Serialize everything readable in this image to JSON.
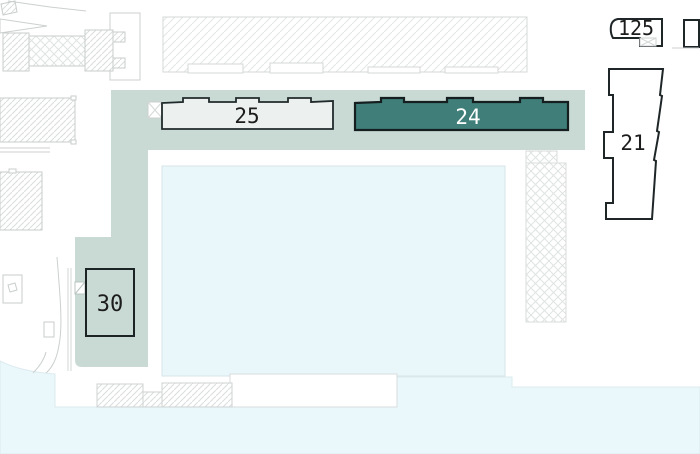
{
  "map": {
    "buildings": [
      {
        "id": "25",
        "label": "25",
        "state": "available-light"
      },
      {
        "id": "24",
        "label": "24",
        "state": "highlighted"
      },
      {
        "id": "21",
        "label": "21",
        "state": "outline"
      },
      {
        "id": "125",
        "label": "125",
        "state": "outline"
      },
      {
        "id": "30",
        "label": "30",
        "state": "outline-on-plaza"
      }
    ],
    "colors": {
      "band_teal": "#c9dad5",
      "highlight_teal": "#3f7e79",
      "building_light": "#ecf1f0",
      "water_light": "#e9f6fa",
      "water_bottom": "#eaf7fb",
      "outline_dark": "#1e2627",
      "outline_gray": "#c9cdcd",
      "hatch_gray": "#dadddd",
      "label_dark": "#1c1c1c",
      "label_light": "#ffffff"
    }
  }
}
